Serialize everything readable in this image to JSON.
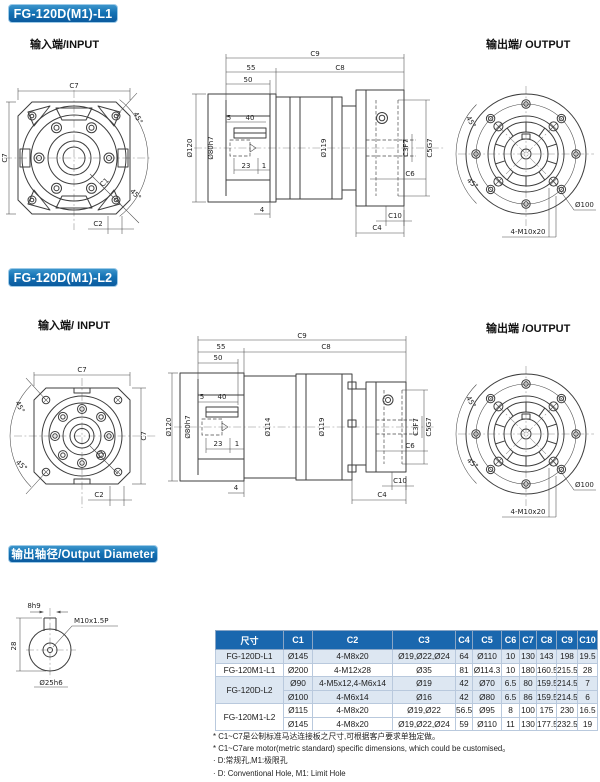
{
  "sections": {
    "l1": {
      "header": "FG-120D(M1)-L1",
      "input_label": "输入端/INPUT",
      "output_label": "输出端/ OUTPUT"
    },
    "l2": {
      "header": "FG-120D(M1)-L2",
      "input_label": "输入端/ INPUT",
      "output_label": "输出端 /OUTPUT"
    },
    "shaft": {
      "header": "输出轴径/Output Diameter"
    }
  },
  "dims": {
    "c1": "C1",
    "c2": "C2",
    "c3": "C3F7",
    "c4": "C4",
    "c5": "C5G7",
    "c6": "C6",
    "c7": "C7",
    "c8": "C8",
    "c9": "C9",
    "c10": "C10",
    "a45": "45°",
    "n55": "55",
    "n50": "50",
    "n5": "5",
    "n40": "40",
    "n23": "23",
    "n1": "1",
    "n4": "4",
    "dia120": "Ø120",
    "dia80": "Ø80h7",
    "dia119": "Ø119",
    "dia114": "Ø114",
    "dia100": "Ø100",
    "bolt_out": "4-M10x20"
  },
  "shaft_dims": {
    "key": "8h9",
    "height": "28",
    "thread": "M10x1.5P",
    "dia": "Ø25h6"
  },
  "table": {
    "headers": [
      "尺寸",
      "C1",
      "C2",
      "C3",
      "C4",
      "C5",
      "C6",
      "C7",
      "C8",
      "C9",
      "C10"
    ],
    "groups": [
      {
        "model": "FG-120D-L1",
        "rows": [
          [
            "Ø145",
            "4-M8x20",
            "Ø19,Ø22,Ø24",
            "64",
            "Ø110",
            "10",
            "130",
            "143",
            "198",
            "19.5"
          ]
        ]
      },
      {
        "model": "FG-120M1-L1",
        "rows": [
          [
            "Ø200",
            "4-M12x28",
            "Ø35",
            "81",
            "Ø114.3",
            "10",
            "180",
            "160.5",
            "215.5",
            "28"
          ]
        ]
      },
      {
        "model": "FG-120D-L2",
        "rows": [
          [
            "Ø90",
            "4-M5x12,4-M6x14",
            "Ø19",
            "42",
            "Ø70",
            "6.5",
            "80",
            "159.5",
            "214.5",
            "7"
          ],
          [
            "Ø100",
            "4-M6x14",
            "Ø16",
            "42",
            "Ø80",
            "6.5",
            "86",
            "159.5",
            "214.5",
            "6"
          ]
        ]
      },
      {
        "model": "FG-120M1-L2",
        "rows": [
          [
            "Ø115",
            "4-M8x20",
            "Ø19,Ø22",
            "56.5",
            "Ø95",
            "8",
            "100",
            "175",
            "230",
            "16.5"
          ],
          [
            "Ø145",
            "4-M8x20",
            "Ø19,Ø22,Ø24",
            "59",
            "Ø110",
            "11",
            "130",
            "177.5",
            "232.5",
            "19"
          ]
        ]
      }
    ]
  },
  "footnotes": [
    "* C1~C7是公制标准马达连接板之尺寸,可根据客户要求单独定做。",
    "* C1~C7are motor(metric standard) specific dimensions, which could be customised。",
    "· D:常规孔,M1:极限孔",
    "· D: Conventional Hole, M1: Limit Hole"
  ],
  "colors": {
    "accent_light": "#3c95cb",
    "accent": "#1472b4",
    "accent_dark": "#0b5a9e",
    "table_header_bg": "#1a67ae",
    "row_shade": "#dde7f2"
  }
}
